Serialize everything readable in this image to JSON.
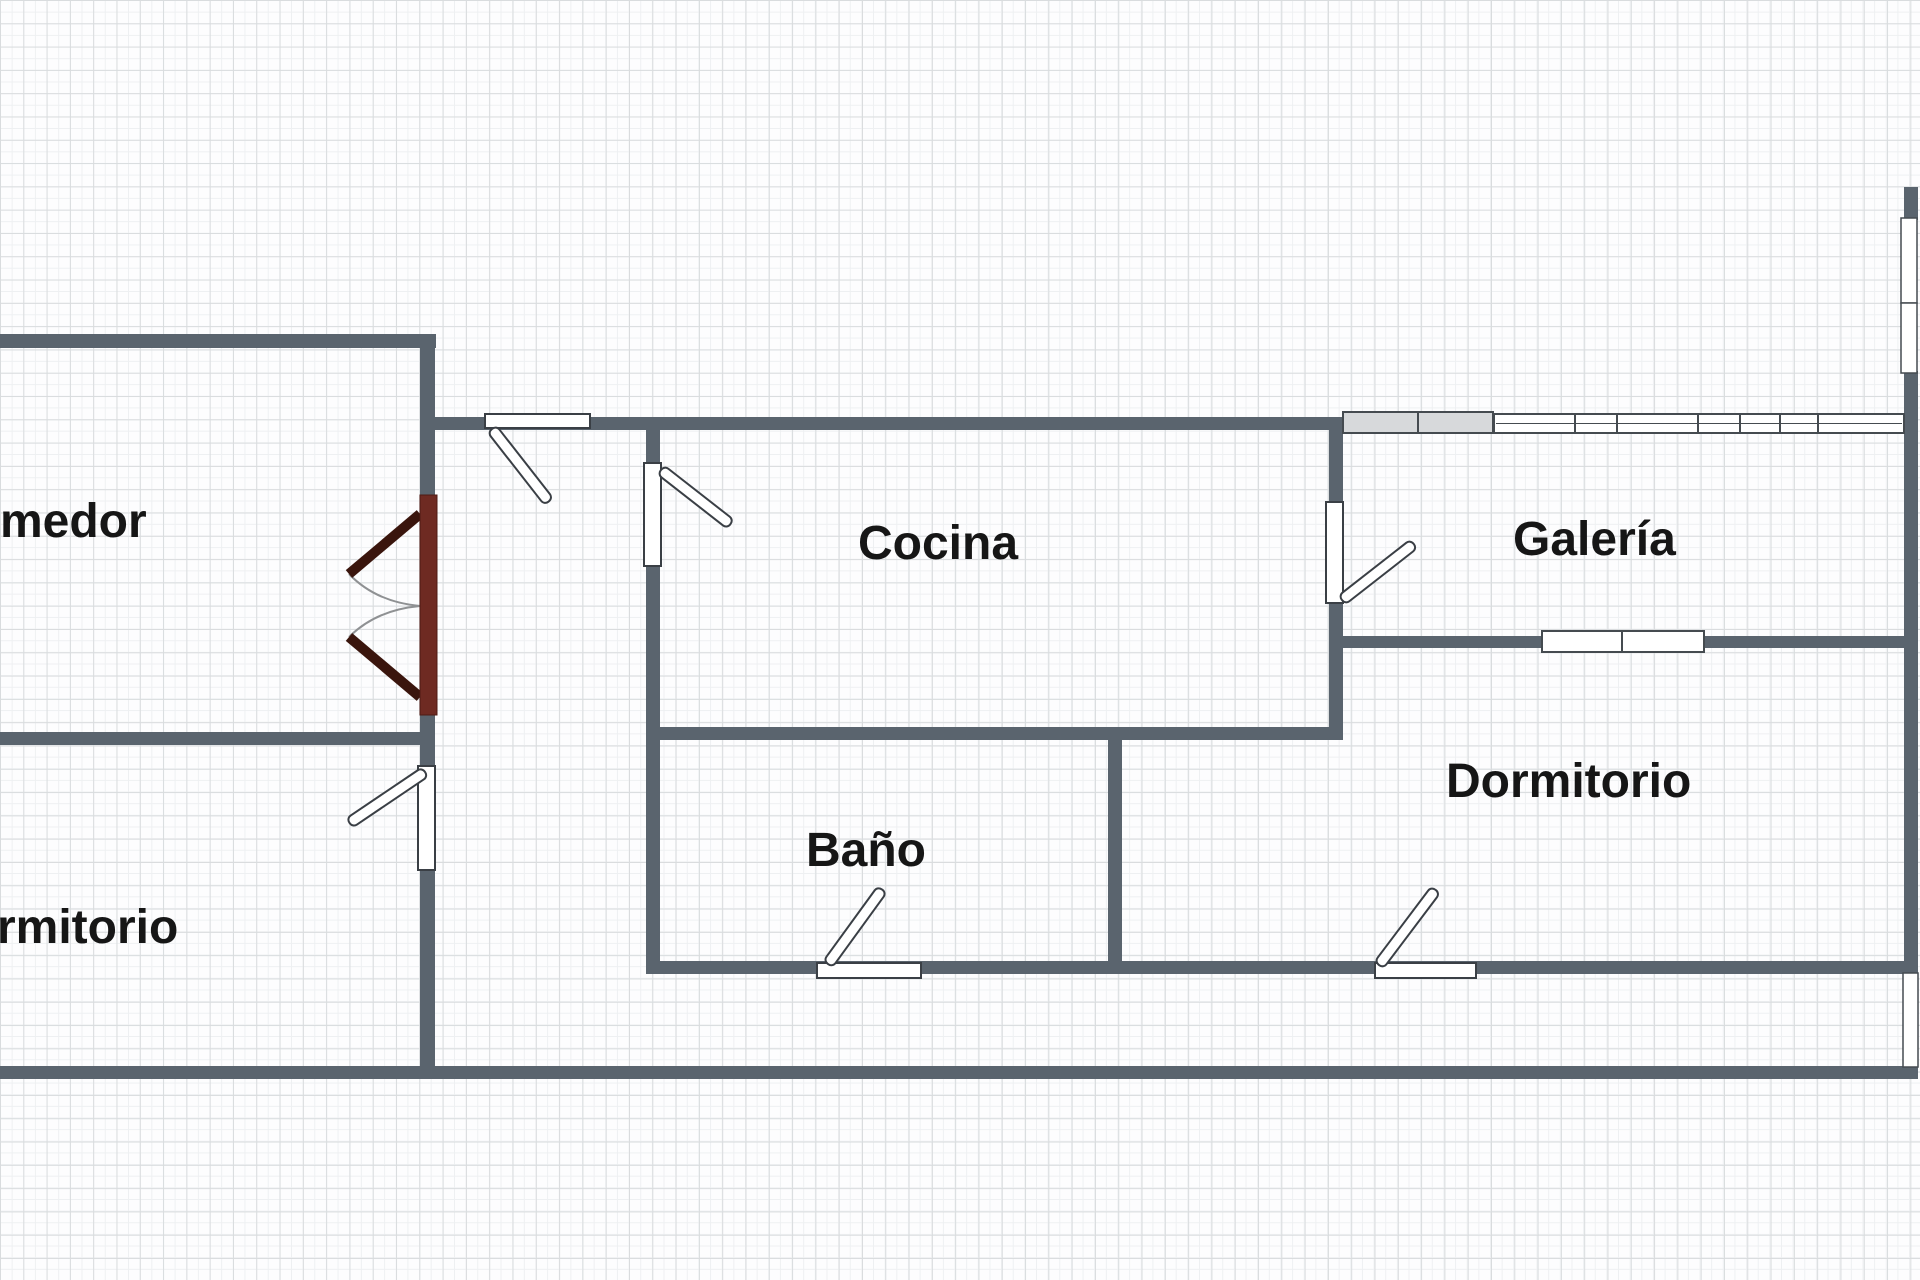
{
  "plan": {
    "width": 1920,
    "height": 1280,
    "grid_size": 23.3
  },
  "colors": {
    "background": "#fdfdfe",
    "grid_line": "#d9dcde",
    "wall": "#5a646e",
    "door_stroke": "#3a3f45",
    "window_stroke": "#454b50",
    "window_fill": "#ffffff",
    "radiator_fill": "#d7d9db",
    "double_door_bar": "#6e2a22",
    "double_door_bar_stroke": "#4f1b14",
    "double_door_leaf": "#3a150d",
    "swing_arc": "#8f9193",
    "label_color": "#161616"
  },
  "rooms": [
    {
      "id": "comedor",
      "label": "Comedor",
      "x": -64,
      "y": 537
    },
    {
      "id": "cocina",
      "label": "Cocina",
      "x": 858,
      "y": 559
    },
    {
      "id": "galeria",
      "label": "Galería",
      "x": 1513,
      "y": 555
    },
    {
      "id": "bano",
      "label": "Baño",
      "x": 806,
      "y": 866
    },
    {
      "id": "dormitorio",
      "label": "Dormitorio",
      "x": 1446,
      "y": 797
    },
    {
      "id": "dormitorio-2",
      "label": "Dormitorio",
      "x": -67,
      "y": 943
    }
  ],
  "walls": [
    {
      "id": "wall-top-left",
      "x": 0,
      "y": 334,
      "w": 436,
      "h": 14
    },
    {
      "id": "wall-left-vertical",
      "x": 420,
      "y": 334,
      "w": 15,
      "h": 744
    },
    {
      "id": "wall-comedor-dormitorio",
      "x": 0,
      "y": 732,
      "w": 424,
      "h": 13
    },
    {
      "id": "wall-hall-cocina-top",
      "x": 432,
      "y": 417,
      "w": 911,
      "h": 13
    },
    {
      "id": "wall-cocina-left",
      "x": 646,
      "y": 417,
      "w": 14,
      "h": 557
    },
    {
      "id": "wall-cocina-bottom",
      "x": 646,
      "y": 727,
      "w": 697,
      "h": 13
    },
    {
      "id": "wall-cocina-right",
      "x": 1329,
      "y": 417,
      "w": 14,
      "h": 323
    },
    {
      "id": "wall-bano-right",
      "x": 1108,
      "y": 727,
      "w": 14,
      "h": 247
    },
    {
      "id": "wall-galeria-top",
      "x": 1343,
      "y": 419,
      "w": 563,
      "h": 10
    },
    {
      "id": "wall-galeria-bottom",
      "x": 1329,
      "y": 636,
      "w": 578,
      "h": 12
    },
    {
      "id": "wall-rooms-bottom",
      "x": 646,
      "y": 961,
      "w": 1261,
      "h": 13
    },
    {
      "id": "wall-outer-bottom",
      "x": 0,
      "y": 1066,
      "w": 1918,
      "h": 13
    },
    {
      "id": "wall-right-top-cap",
      "x": 1904,
      "y": 187,
      "w": 14,
      "h": 33
    },
    {
      "id": "wall-right-main",
      "x": 1904,
      "y": 371,
      "w": 14,
      "h": 602
    }
  ],
  "windows": [
    {
      "id": "window-galeria-radiator",
      "type": "radiator",
      "x": 1343,
      "y": 412,
      "w": 150,
      "h": 21,
      "ticks": [
        1418
      ]
    },
    {
      "id": "window-galeria-top",
      "type": "glazed",
      "x": 1494,
      "y": 414,
      "w": 410,
      "h": 19,
      "midline": true,
      "ticks": [
        1575,
        1617,
        1698,
        1740,
        1780,
        1818
      ]
    },
    {
      "id": "window-galeria-inner",
      "type": "glazed",
      "x": 1542,
      "y": 631,
      "w": 162,
      "h": 21,
      "midline": false,
      "ticks": [
        1622
      ]
    },
    {
      "id": "window-right-upper",
      "type": "glazed-v",
      "x": 1901,
      "y": 218,
      "w": 16,
      "h": 85
    },
    {
      "id": "window-right-lower",
      "type": "glazed-v",
      "x": 1901,
      "y": 303,
      "w": 16,
      "h": 70
    },
    {
      "id": "opening-right-bottom",
      "type": "glazed-v",
      "x": 1903,
      "y": 973,
      "w": 15,
      "h": 94
    }
  ],
  "doors": [
    {
      "id": "door-hall-top",
      "opening": {
        "x": 485,
        "y": 414,
        "w": 105,
        "h": 14
      },
      "hinge": [
        492,
        429
      ],
      "angle": 52,
      "len": 92
    },
    {
      "id": "door-cocina",
      "opening": {
        "x": 644,
        "y": 463,
        "w": 17,
        "h": 103
      },
      "hinge": [
        661,
        470
      ],
      "angle": 38,
      "len": 88
    },
    {
      "id": "door-galeria",
      "opening": {
        "x": 1326,
        "y": 502,
        "w": 17,
        "h": 101
      },
      "hinge": [
        1342,
        600
      ],
      "angle": -38,
      "len": 91
    },
    {
      "id": "door-bano",
      "opening": {
        "x": 817,
        "y": 963,
        "w": 104,
        "h": 15
      },
      "hinge": [
        828,
        964
      ],
      "angle": -54,
      "len": 92
    },
    {
      "id": "door-dormitorio",
      "opening": {
        "x": 1375,
        "y": 963,
        "w": 101,
        "h": 15
      },
      "hinge": [
        1379,
        965
      ],
      "angle": -53,
      "len": 94
    },
    {
      "id": "door-dormitorio-left",
      "opening": {
        "x": 418,
        "y": 766,
        "w": 17,
        "h": 104
      },
      "hinge": [
        425,
        772
      ],
      "angle": 146,
      "len": 91
    }
  ],
  "double_door": {
    "id": "double-door-comedor",
    "bar": {
      "x": 420,
      "y": 495,
      "w": 17,
      "h": 220
    },
    "leaves": [
      {
        "x1": 420,
        "y1": 514,
        "x2": 349,
        "y2": 574
      },
      {
        "x1": 420,
        "y1": 697,
        "x2": 349,
        "y2": 637
      }
    ],
    "arcs": [
      "M 349 574 Q 376 602 420 606",
      "M 349 637 Q 376 610 420 606"
    ]
  }
}
